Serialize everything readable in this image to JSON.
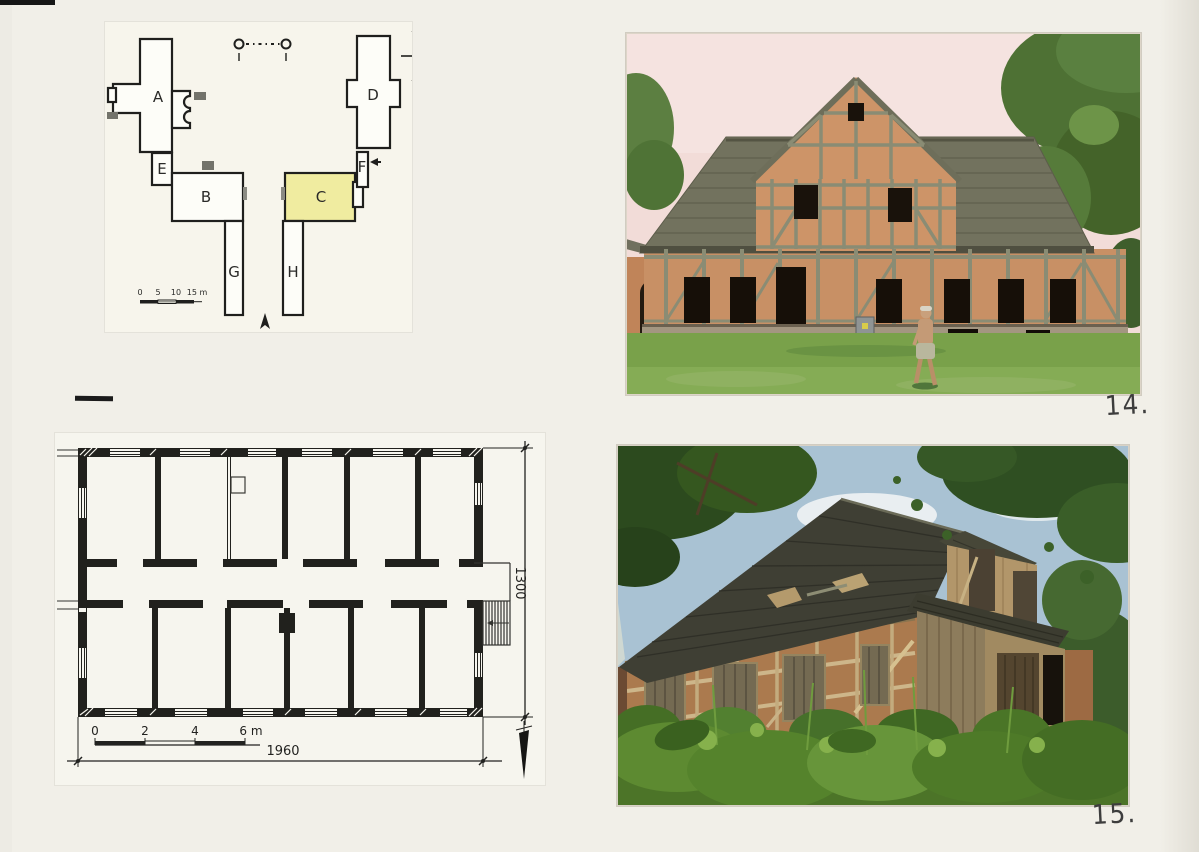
{
  "figures": [
    {
      "label": "14."
    },
    {
      "label": "15."
    }
  ],
  "site_plan": {
    "labels": [
      "A",
      "B",
      "C",
      "D",
      "E",
      "F",
      "G",
      "H"
    ],
    "scale_ticks": [
      "0",
      "5",
      "10",
      "15 m"
    ],
    "highlight_color": "#f0eca0"
  },
  "floor_plan": {
    "scale_ticks": [
      "0",
      "2",
      "4",
      "6 m"
    ],
    "width_label": "1960",
    "height_label": "1300"
  }
}
